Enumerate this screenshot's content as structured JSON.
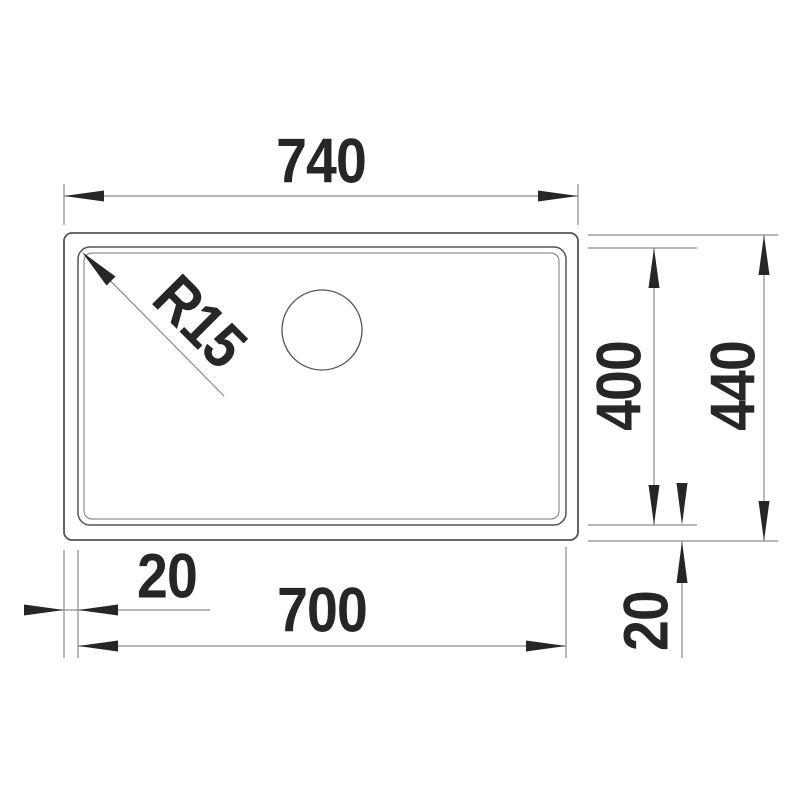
{
  "drawing": {
    "labels": {
      "overall_width": "740",
      "overall_depth": "440",
      "bowl_depth": "400",
      "bowl_width": "700",
      "rim_offset_left": "20",
      "rim_offset_bottom": "20",
      "corner_radius": "R15"
    },
    "colors": {
      "background": "#ffffff",
      "object_line": "#555555",
      "detail_line": "#777777",
      "dimension_line": "#8c8c8c",
      "text_and_arrows": "#262626"
    }
  }
}
